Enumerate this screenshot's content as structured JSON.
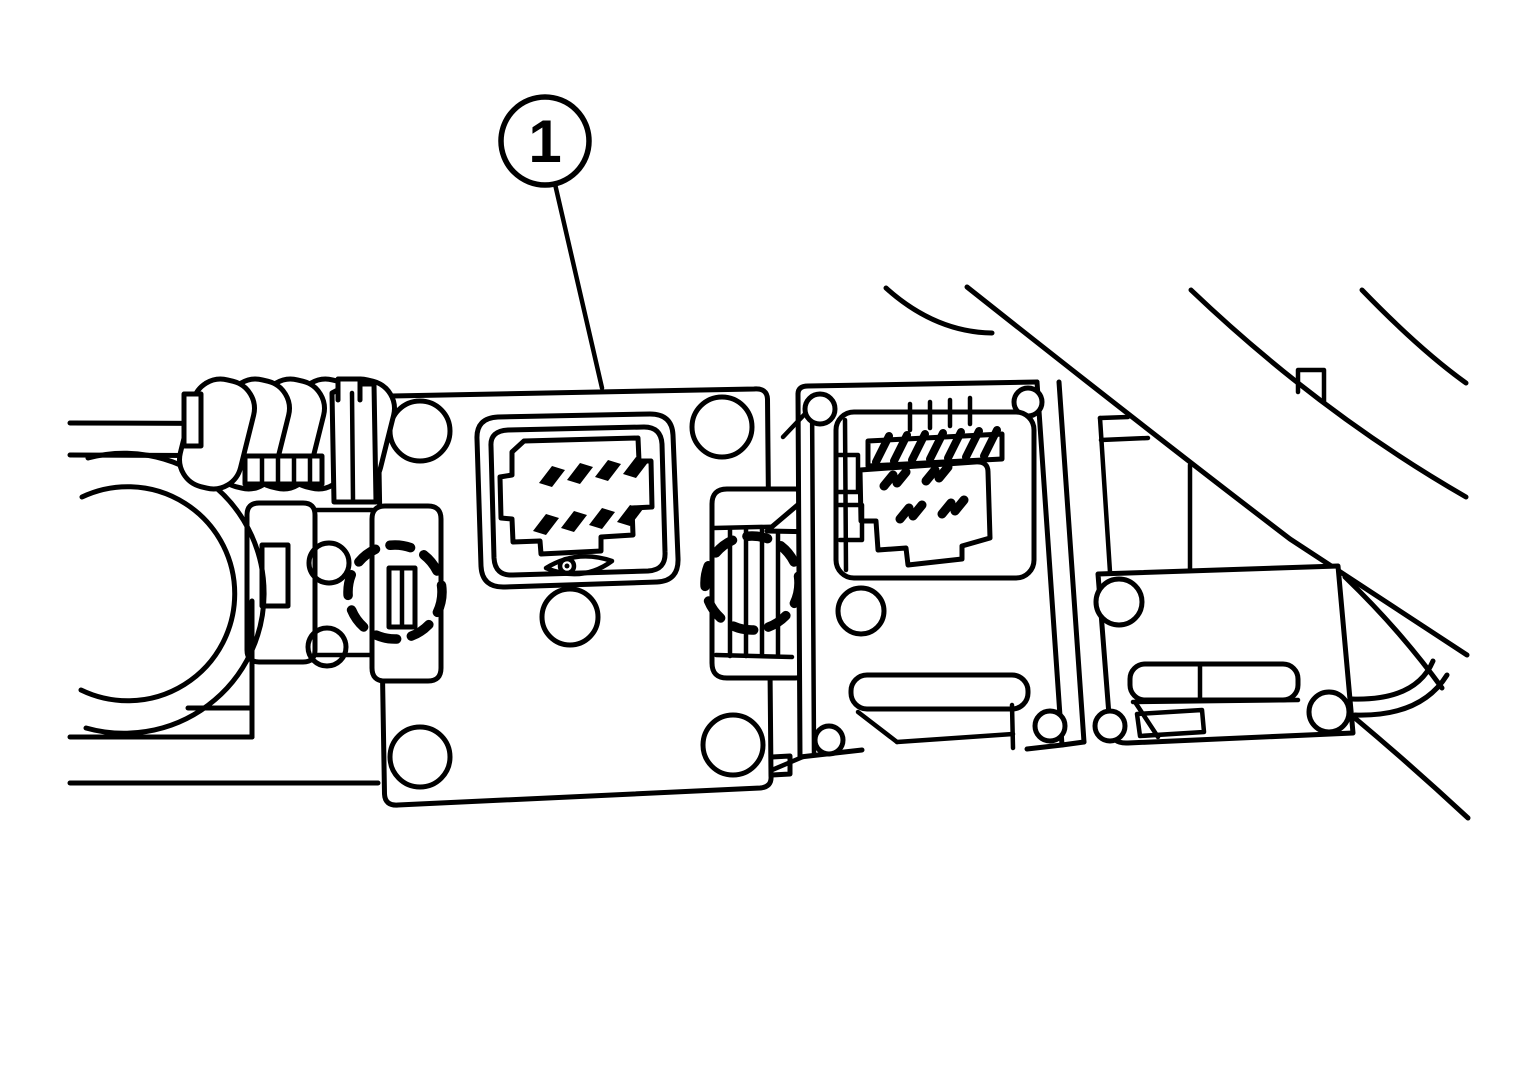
{
  "figure": {
    "background_color": "#ffffff",
    "line_color": "#000000",
    "callout": {
      "label": "1"
    },
    "emphasis_markers": [
      {
        "style": "dashed-circle",
        "part": "left-retaining-clip"
      },
      {
        "style": "dashed-circle",
        "part": "right-retaining-clip"
      }
    ],
    "parts": [
      "wire-loom-sleeve",
      "mounting-plate-with-screw-holes",
      "eight-pin-connector-socket",
      "retaining-clip-left",
      "retaining-clip-right",
      "four-pin-connector",
      "harness-cover-panel",
      "diagonal-harness-branch"
    ]
  }
}
